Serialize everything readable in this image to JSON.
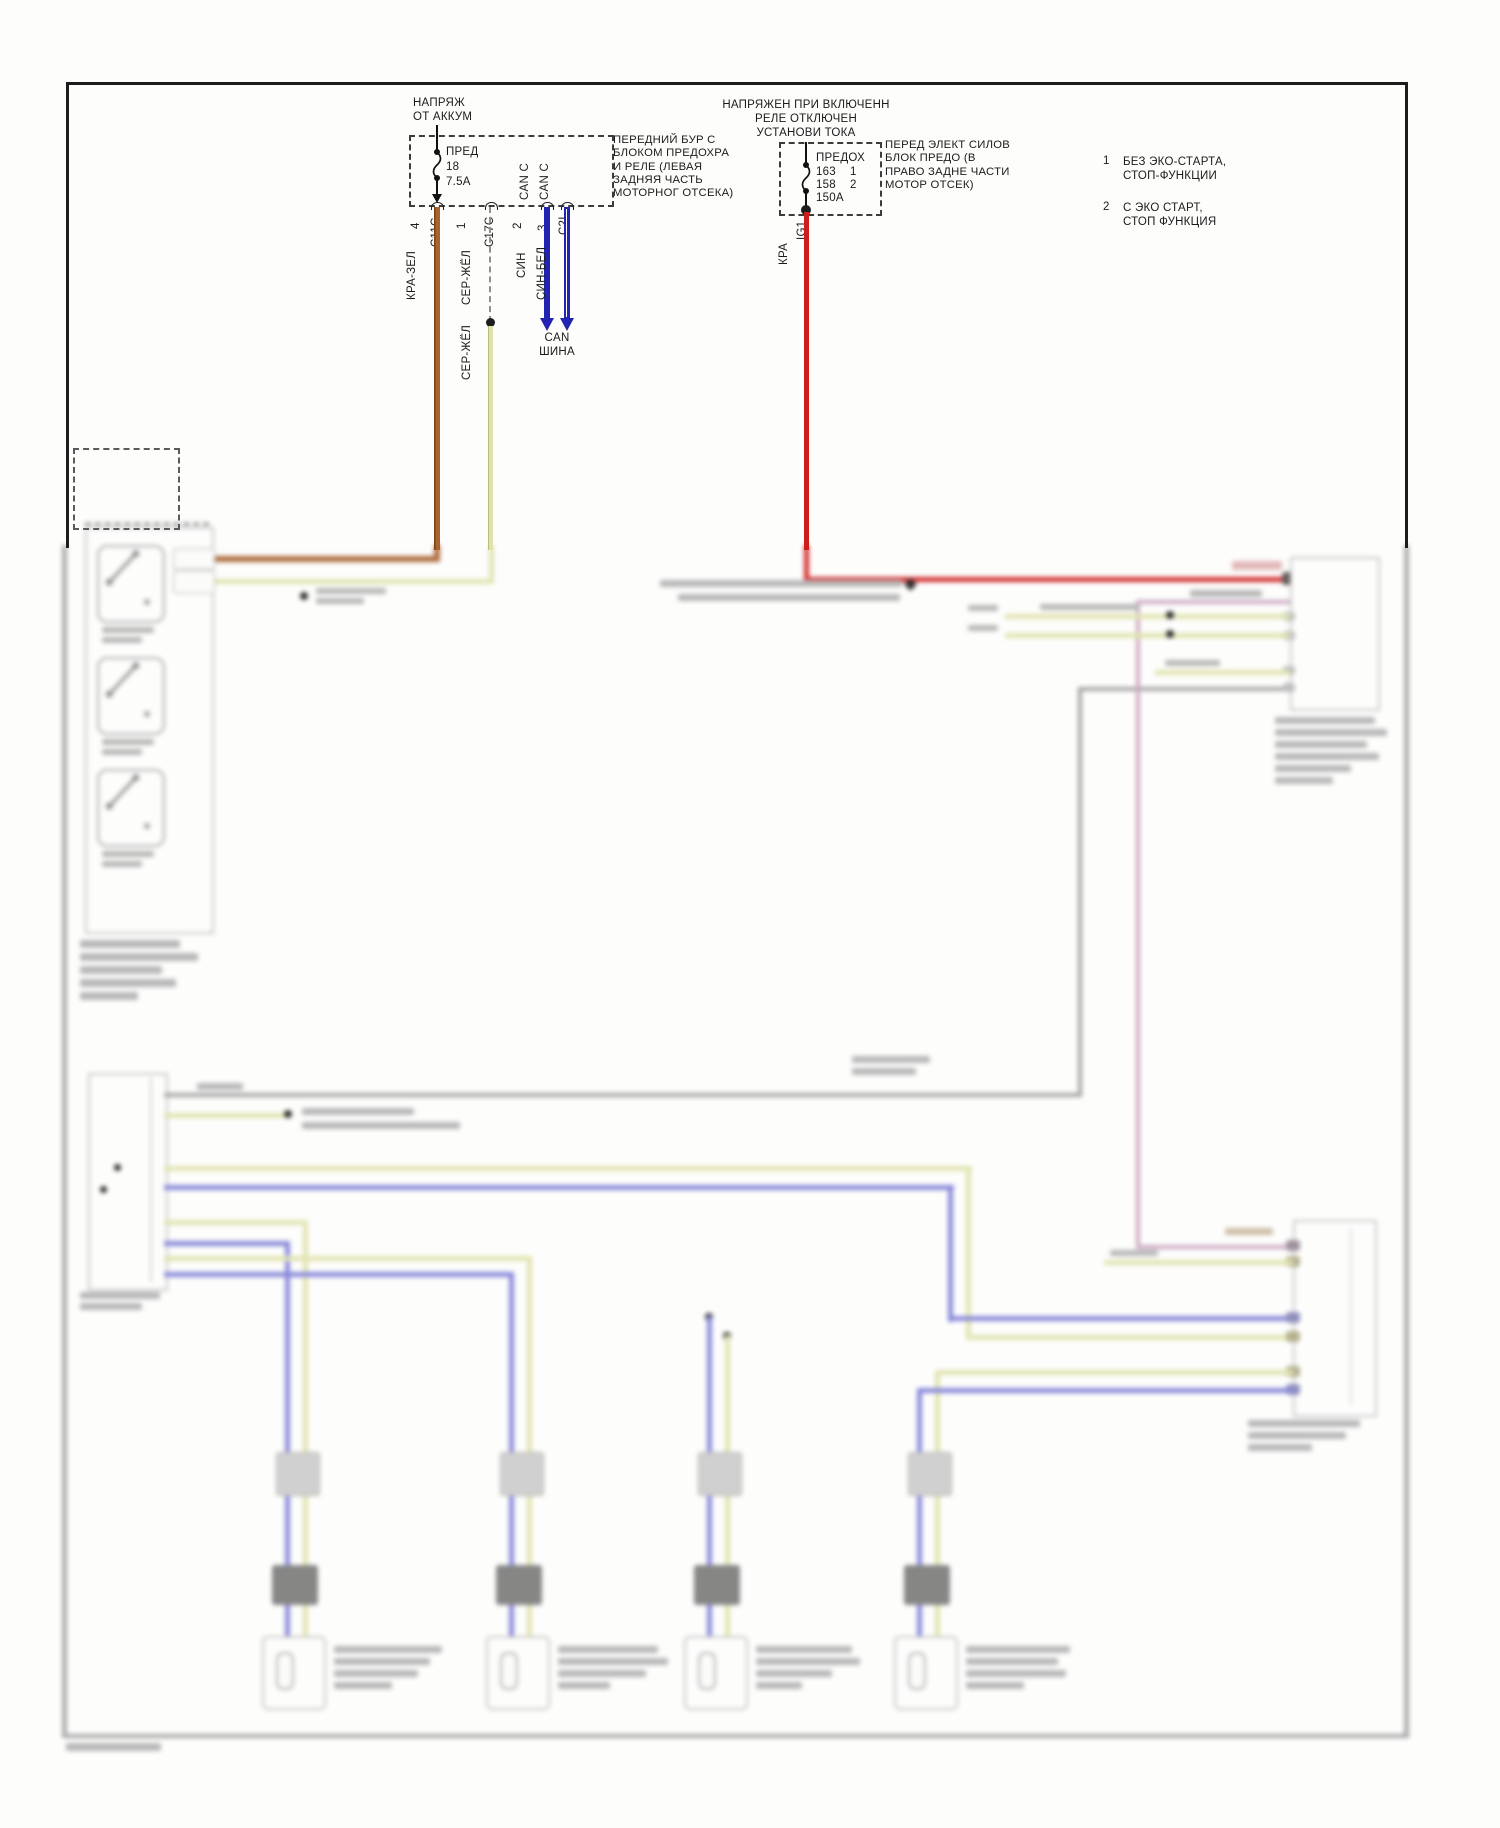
{
  "colors": {
    "frame": "#1c1c1c",
    "wire_orange": "#a96230",
    "wire_yellow": "#dfe2ab",
    "wire_blue": "#2323b2",
    "wire_blue_soft": "#8181d8",
    "wire_red": "#cf1d1d",
    "wire_gray": "#9c9c9c",
    "wire_mauve": "#c9a3bd",
    "dash_gray": "#8f8f8f",
    "smudge": "#b2b2b2",
    "box_border": "#c2c2c2"
  },
  "battery_box": {
    "title_lines": [
      "НАПРЯЖ",
      "ОТ АККУМ"
    ],
    "fuse_name": "ПРЕД",
    "fuse_number": "18",
    "fuse_rating": "7.5A",
    "pin4": "4",
    "pin1": "1",
    "pin2": "2",
    "pin3": "3",
    "conn_c11c": "C11C",
    "conn_c17c": "C17C",
    "conn_c2i": "C2I",
    "can_c_left": "CAN C",
    "can_c_right": "CAN C",
    "desc_lines": [
      "ПЕРЕДНИЙ БУР С",
      "БЛОКОМ ПРЕДОХРА",
      "И РЕЛЕ (ЛЕВАЯ",
      "ЗАДНЯЯ ЧАСТЬ",
      "МОТОРНОГ ОТСЕКА)"
    ]
  },
  "ignition_box": {
    "title_lines": [
      "НАПРЯЖЕН ПРИ ВКЛЮЧЕНН",
      "РЕЛЕ ОТКЛЮЧЕН",
      "УСТАНОВИ ТОКА"
    ],
    "fuse_name": "ПРЕДОХ",
    "fuse_row1_val": "163",
    "fuse_row1_ref": "1",
    "fuse_row2_val": "158",
    "fuse_row2_ref": "2",
    "fuse_rating": "150A",
    "pin_ig1": "IG1",
    "desc_lines": [
      "ПЕРЕД ЭЛЕКТ СИЛОВ",
      "БЛОК ПРЕДО (В",
      "ПРАВО ЗАДНЕ ЧАСТИ",
      "МОТОР ОТСЕК)"
    ]
  },
  "wire_labels": {
    "kra_zel": "КРА-ЗЕЛ",
    "ser_zhel_top": "СЕР-ЖЁЛ",
    "ser_zhel_bottom": "СЕР-ЖЁЛ",
    "sin": "СИН",
    "sin_bel": "СИН-БЕЛ",
    "kra": "КРА"
  },
  "can_bus": {
    "line1": "CAN",
    "line2": "ШИНА"
  },
  "notes": [
    {
      "num": "1",
      "line1": "БЕЗ ЭКО-СТАРТА,",
      "line2": "СТОП-ФУНКЦИИ"
    },
    {
      "num": "2",
      "line1": "С ЭКО СТАРТ,",
      "line2": "СТОП ФУНКЦИЯ"
    }
  ]
}
